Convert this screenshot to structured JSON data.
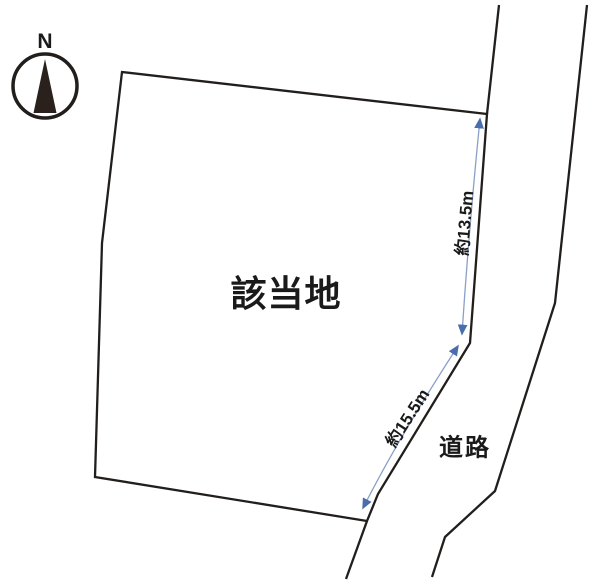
{
  "diagram": {
    "type": "land-plot-site-plan",
    "site_label": "該当地",
    "road_label": "道路",
    "compass": {
      "label": "N",
      "direction": "up"
    },
    "dimensions": [
      {
        "label": "約13.5m",
        "side": "east-upper-frontage"
      },
      {
        "label": "約15.5m",
        "side": "east-lower-frontage"
      }
    ],
    "colors": {
      "background": "#ffffff",
      "outline": "#211e1c",
      "compass_needle": "#2a211d",
      "arrow_head": "#4a6dae",
      "arrow_shaft": "#8aa0c8",
      "text": "#1a1a1a"
    }
  }
}
